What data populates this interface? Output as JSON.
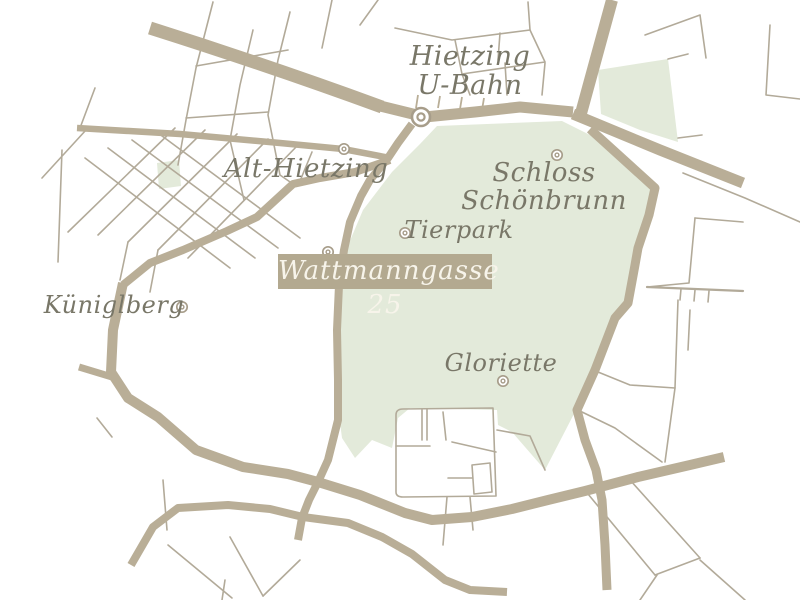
{
  "map": {
    "labels": {
      "hietzing_line1": "Hietzing",
      "hietzing_line2": "U-Bahn",
      "alt_hietzing": "Alt-Hietzing",
      "schloss_line1": "Schloss",
      "schloss_line2": "Schönbrunn",
      "tierpark": "Tierpark",
      "address_badge": "Wattmanngasse 25",
      "kueniglberg": "Küniglberg",
      "gloriette": "Gloriette"
    },
    "markers": [
      {
        "name": "ubahn-station-marker",
        "label": "Hietzing U-Bahn"
      },
      {
        "name": "alt-hietzing-marker",
        "label": "Alt-Hietzing"
      },
      {
        "name": "schloss-schoenbrunn-marker",
        "label": "Schloss Schönbrunn"
      },
      {
        "name": "tierpark-marker",
        "label": "Tierpark"
      },
      {
        "name": "wattmanngasse-25-marker",
        "label": "Wattmanngasse 25"
      },
      {
        "name": "kueniglberg-marker",
        "label": "Küniglberg"
      },
      {
        "name": "gloriette-marker",
        "label": "Gloriette"
      }
    ]
  },
  "theme": {
    "colors": {
      "bg": "#ffffff",
      "park": "#e3eada",
      "road": "#b9ae97",
      "street": "#b2aa99",
      "text": "#797768",
      "badge": "#b3a990",
      "badge-text": "#f7f4ea",
      "marker": "#a79d8a"
    }
  }
}
